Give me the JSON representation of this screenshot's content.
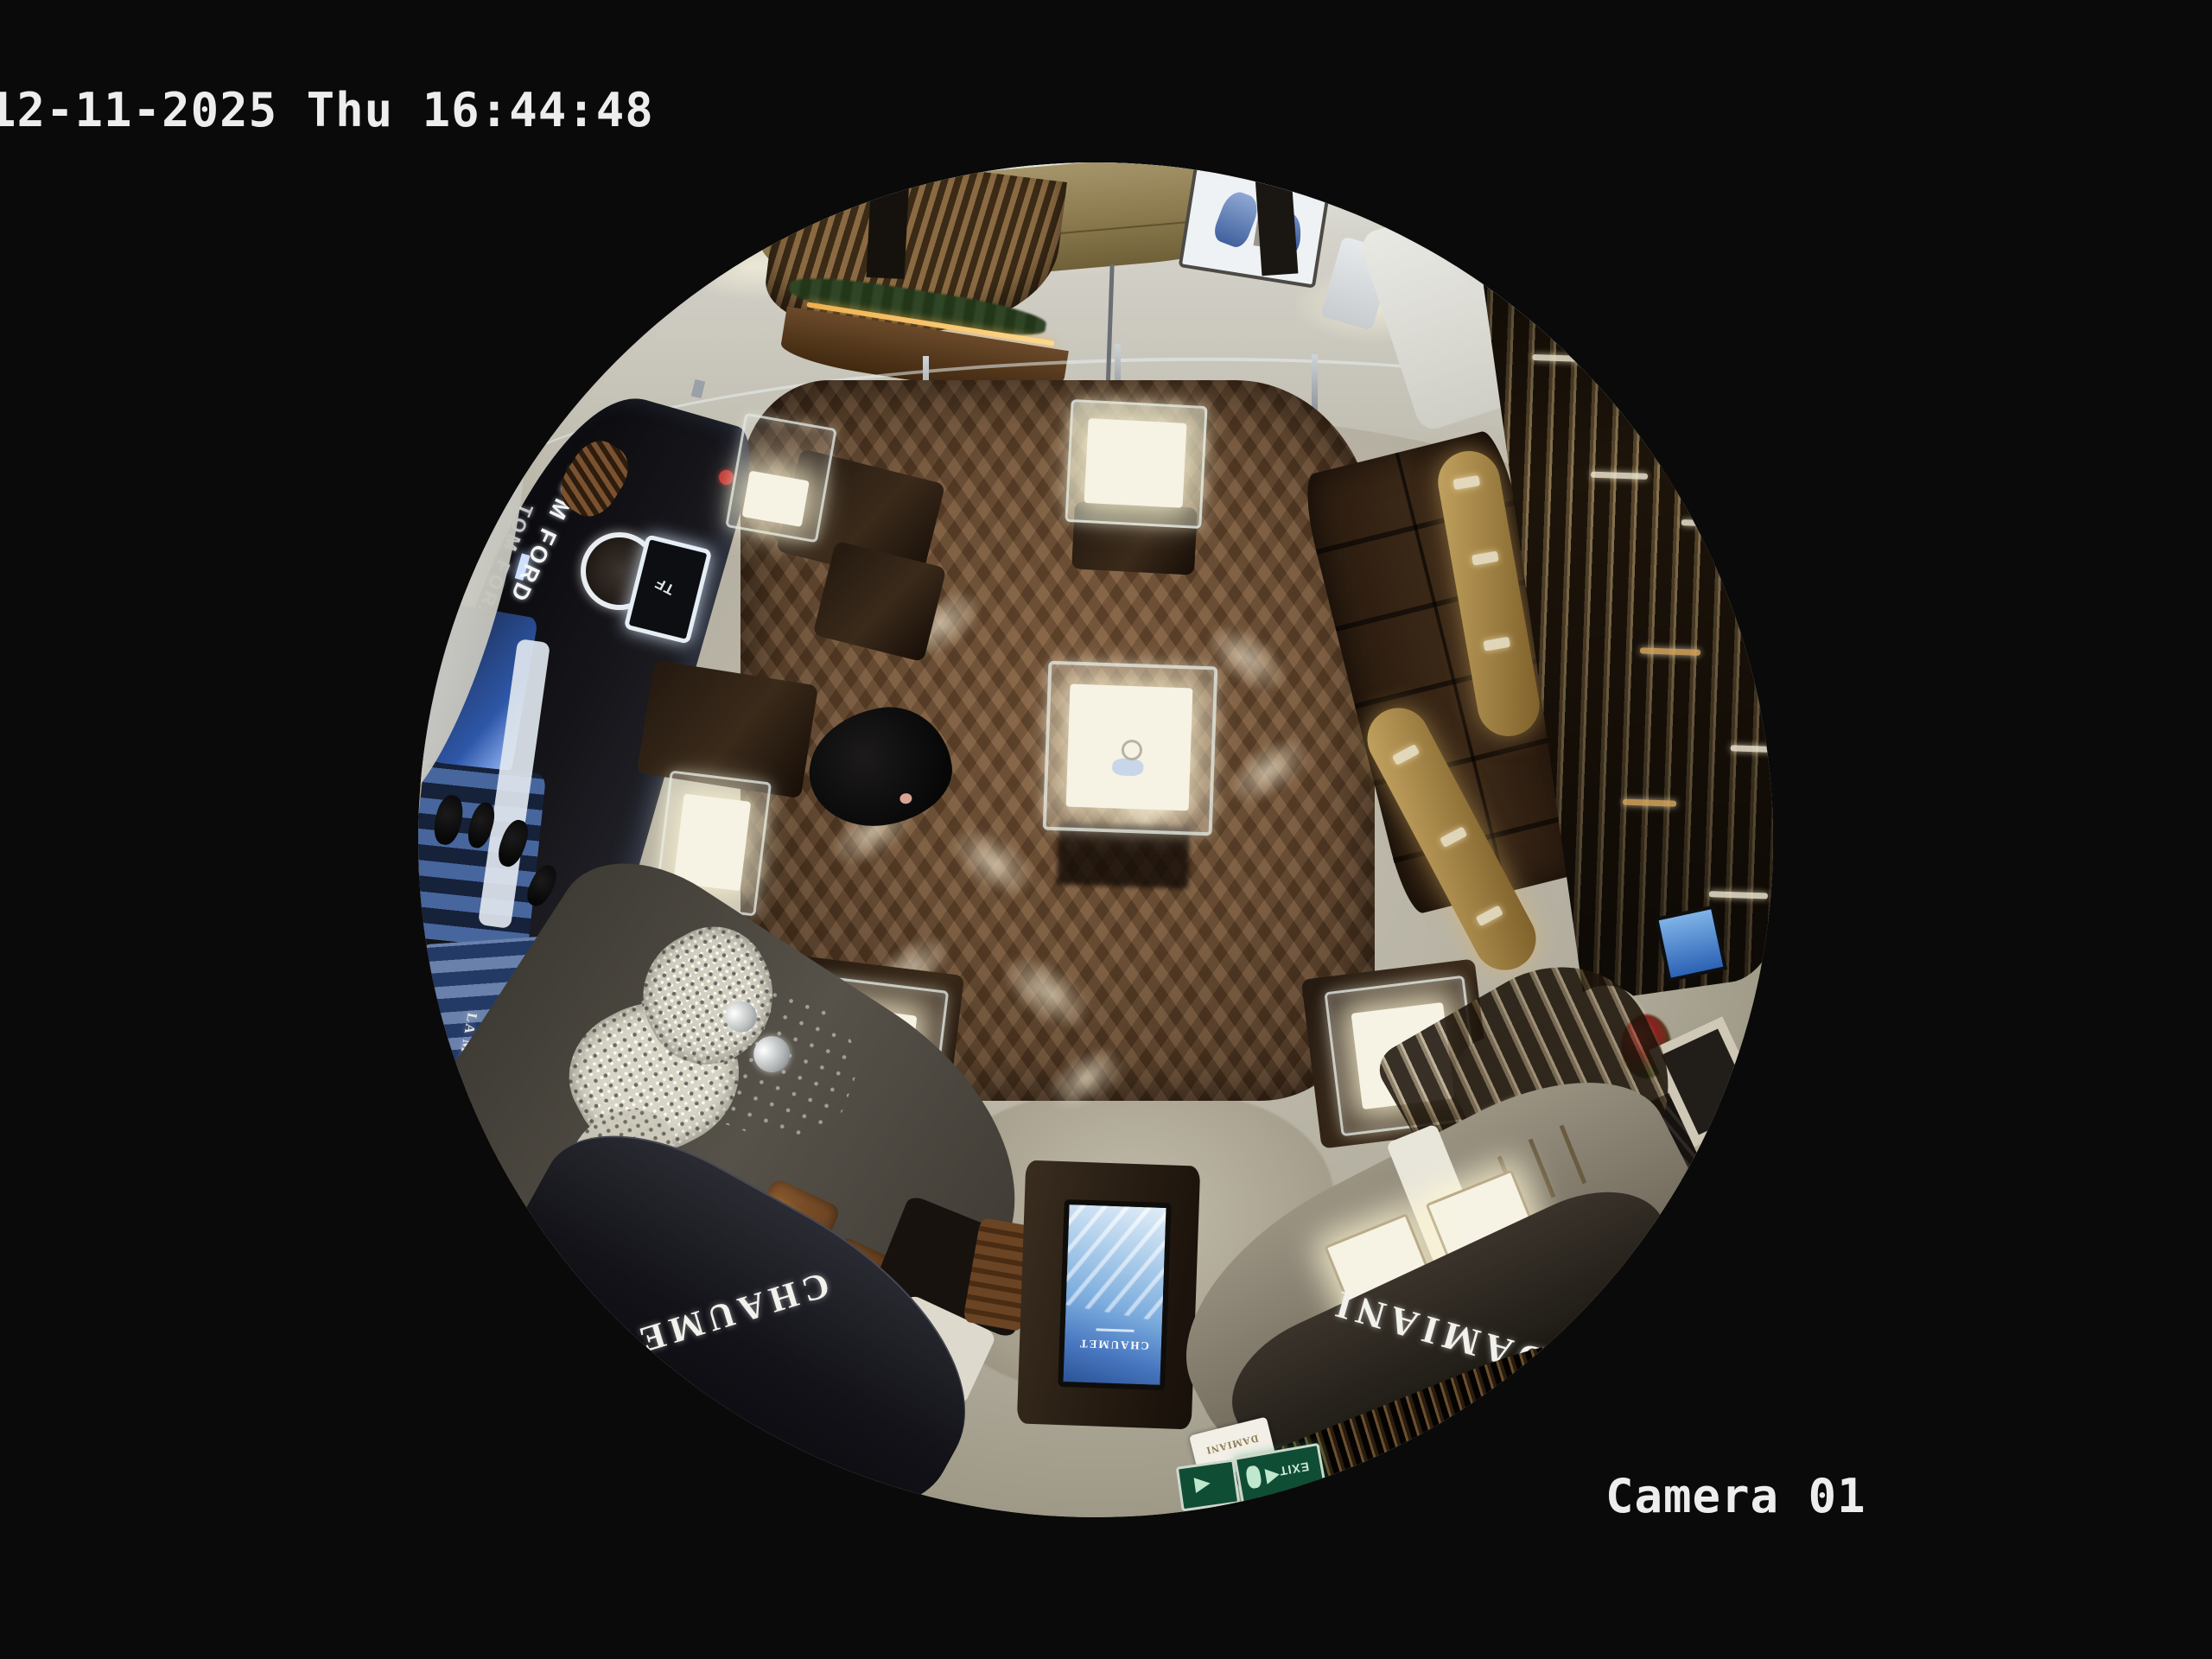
{
  "osd": {
    "timestamp": "12-11-2025 Thu 16:44:48",
    "camera_label": "Camera 01"
  },
  "scene": {
    "signs": {
      "tom_ford": "TOM FORD",
      "tf_monogram": "TF",
      "chaumet": "CHAUMET",
      "chaumet_screen": "CHAUMET",
      "damiani": "DAMIANI",
      "damiani_plaque": "DAMIANI",
      "la_mer": "LA MER",
      "exit": "EXIT",
      "gold_wall": "CONCH"
    },
    "colors": {
      "background": "#0a0a0a",
      "osd_text": "#ededed",
      "wood_floor": "#6a4a2f",
      "tile_floor": "#b3ae9f",
      "marble_floor": "#c9c6bc",
      "gold_wall": "#8f7c4e",
      "facade_dark": "#15151a",
      "screen_blue": "#4f83cc",
      "exit_green": "#13543a",
      "brass_accent": "#c59a3e"
    }
  }
}
